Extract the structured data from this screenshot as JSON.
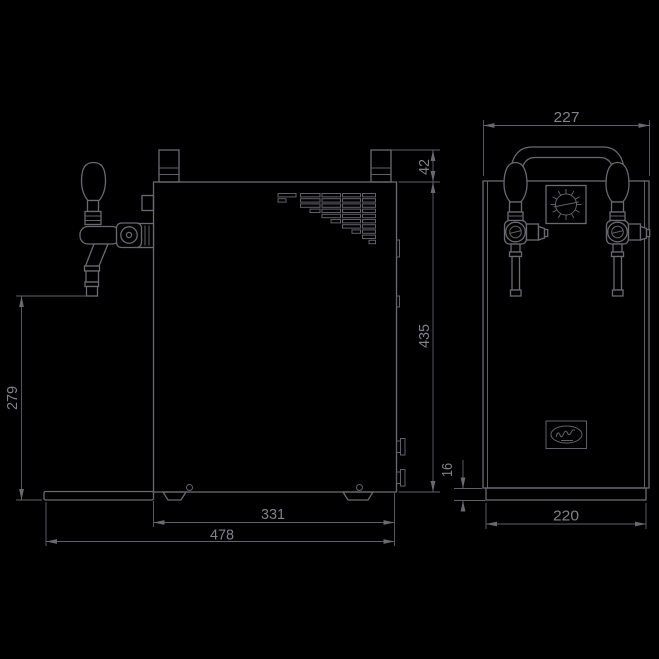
{
  "drawing": {
    "type": "technical-dimension-drawing",
    "subject": "two-tap beer cooler, side and front orthographic views",
    "background_color": "#000000",
    "line_color": "#696971"
  },
  "side_view": {
    "dims": {
      "connector_height": "42",
      "body_height": "435",
      "tap_to_ground": "279",
      "body_depth": "331",
      "overall_depth": "478"
    }
  },
  "front_view": {
    "dims": {
      "overall_width": "227",
      "base_width": "220",
      "base_height": "16"
    }
  },
  "icons": {
    "thermostat": "snowflake-dial-icon",
    "brand": "oval-script-logo-icon"
  }
}
